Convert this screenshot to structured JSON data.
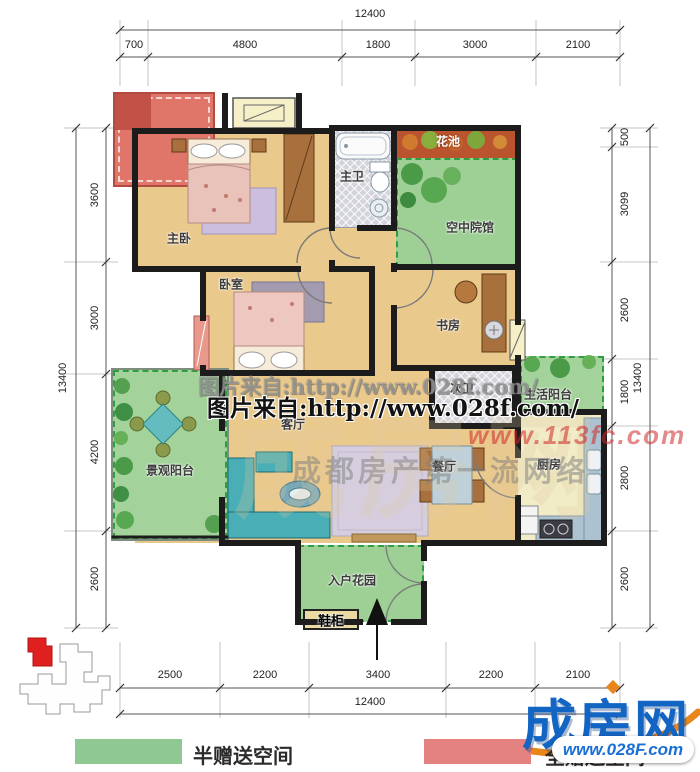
{
  "dims": {
    "top": {
      "total": "12400",
      "segments": [
        "700",
        "4800",
        "1800",
        "3000",
        "2100"
      ]
    },
    "bottom": {
      "total": "12400",
      "segments": [
        "2500",
        "2200",
        "3400",
        "2200",
        "2100"
      ]
    },
    "left": {
      "total": "13400",
      "segments": [
        "3600",
        "3000",
        "4200",
        "2600"
      ]
    },
    "right": {
      "total": "13400",
      "segments": [
        "500",
        "3099",
        "2600",
        "1800",
        "2800",
        "2600"
      ]
    }
  },
  "rooms": {
    "master_bedroom": "主卧",
    "bedroom": "卧室",
    "master_bath": "主卫",
    "second_bath": "次卫",
    "study": "书房",
    "living_room": "客厅",
    "dining_room": "餐厅",
    "kitchen": "厨房",
    "flower_bed": "花池",
    "sky_courtyard": "空中院馆",
    "life_balcony": "生活阳台",
    "view_balcony": "景观阳台",
    "entry_garden": "入户花园",
    "shoe_cabinet": "鞋柜"
  },
  "watermarks": {
    "source_line_faint": "图片来自:http://www.028f.com/",
    "source_line_bold": "图片来自:http://www.028f.com/",
    "red_url": "www.113fc.com",
    "gray_text": "成都房产第一流网络",
    "big_faint": "成房网"
  },
  "logo": {
    "name": "成房网",
    "url": "www.028F.com",
    "blue": "#1365c4",
    "orange": "#e8861c"
  },
  "legend": [
    {
      "label": "半赠送空间",
      "color": "#8fc893"
    },
    {
      "label": "全赠送空间",
      "color": "#e48181"
    }
  ]
}
